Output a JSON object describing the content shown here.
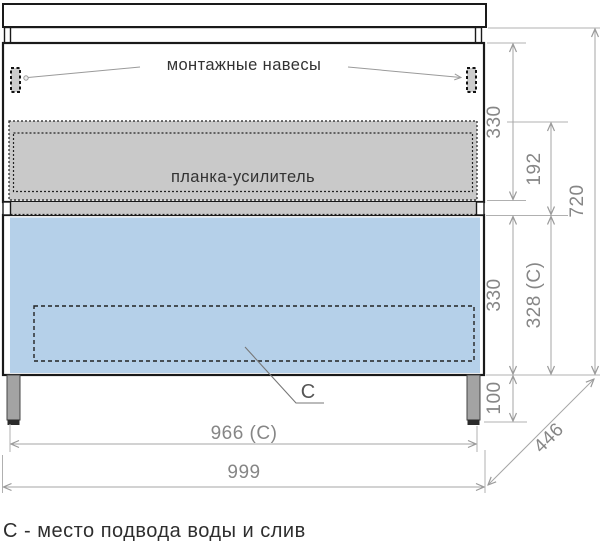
{
  "labels": {
    "mounting_hangers": "монтажные навесы",
    "reinforcement_bar": "планка-усилитель",
    "connection_marker": "С",
    "legend": "С - место подвода воды и слив"
  },
  "dims": {
    "top_section_height": "330",
    "bar_offset_height": "192",
    "cabinet_height": "720",
    "bottom_section_height": "330",
    "bottom_inner_height": "328 (С)",
    "leg_height": "100",
    "connection_width": "966 (С)",
    "total_width": "999",
    "depth": "446"
  },
  "colors": {
    "drawer_front_fill": "#b5d0e9",
    "reinforcement_fill": "#c9c9c9",
    "leg_fill": "#a3a3a3",
    "outline": "#1a1a1a",
    "dimension_line": "#a6a6a6",
    "dimension_text": "#868686",
    "label_text": "#333333"
  }
}
